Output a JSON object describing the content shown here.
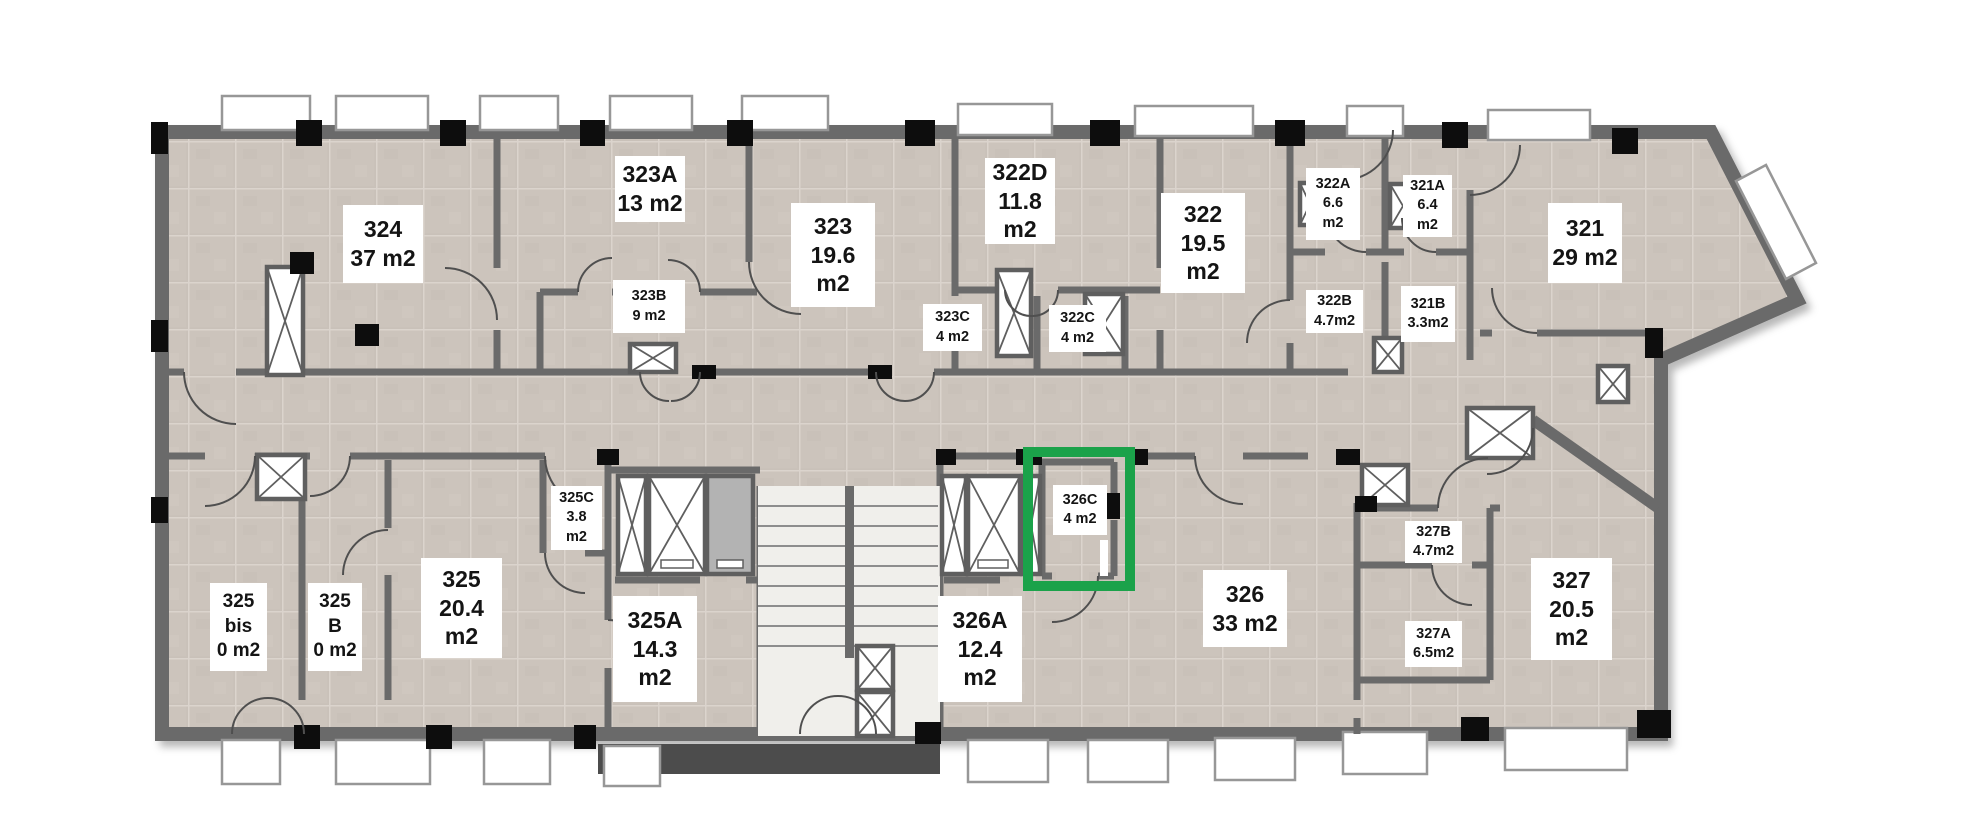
{
  "selected_room": "326C",
  "palette": {
    "wall": "#6a6a6a",
    "tile": "#cac2ba",
    "grout": "#dbd4cd",
    "column": "#0d0d0d",
    "window_fill": "#ffffff",
    "stair_fill": "#f0efeb",
    "highlight_green": "#1ba24a"
  },
  "rooms": [
    {
      "id": "324",
      "l1": "324",
      "l2": "37 m2"
    },
    {
      "id": "323A",
      "l1": "323A",
      "l2": "13 m2"
    },
    {
      "id": "323B",
      "l1": "323B",
      "l2": "9 m2"
    },
    {
      "id": "323",
      "l1": "323",
      "l2": "19.6",
      "l3": "m2"
    },
    {
      "id": "323C",
      "l1": "323C",
      "l2": "4 m2"
    },
    {
      "id": "322D",
      "l1": "322D",
      "l2": "11.8",
      "l3": "m2"
    },
    {
      "id": "322C",
      "l1": "322C",
      "l2": "4 m2"
    },
    {
      "id": "322",
      "l1": "322",
      "l2": "19.5",
      "l3": "m2"
    },
    {
      "id": "322A",
      "l1": "322A",
      "l2": "6.6",
      "l3": "m2"
    },
    {
      "id": "321A",
      "l1": "321A",
      "l2": "6.4",
      "l3": "m2"
    },
    {
      "id": "322B",
      "l1": "322B",
      "l2": "4.7m2"
    },
    {
      "id": "321B",
      "l1": "321B",
      "l2": "3.3m2"
    },
    {
      "id": "321",
      "l1": "321",
      "l2": "29 m2"
    },
    {
      "id": "325bis",
      "l1": "325",
      "l2": "bis",
      "l3": "0 m2"
    },
    {
      "id": "325B",
      "l1": "325",
      "l2": "B",
      "l3": "0 m2"
    },
    {
      "id": "325",
      "l1": "325",
      "l2": "20.4",
      "l3": "m2"
    },
    {
      "id": "325C",
      "l1": "325C",
      "l2": "3.8",
      "l3": "m2"
    },
    {
      "id": "325A",
      "l1": "325A",
      "l2": "14.3",
      "l3": "m2"
    },
    {
      "id": "326A",
      "l1": "326A",
      "l2": "12.4",
      "l3": "m2"
    },
    {
      "id": "326C",
      "l1": "326C",
      "l2": "4 m2"
    },
    {
      "id": "326",
      "l1": "326",
      "l2": "33 m2"
    },
    {
      "id": "327B",
      "l1": "327B",
      "l2": "4.7m2"
    },
    {
      "id": "327A",
      "l1": "327A",
      "l2": "6.5m2"
    },
    {
      "id": "327",
      "l1": "327",
      "l2": "20.5",
      "l3": "m2"
    }
  ]
}
